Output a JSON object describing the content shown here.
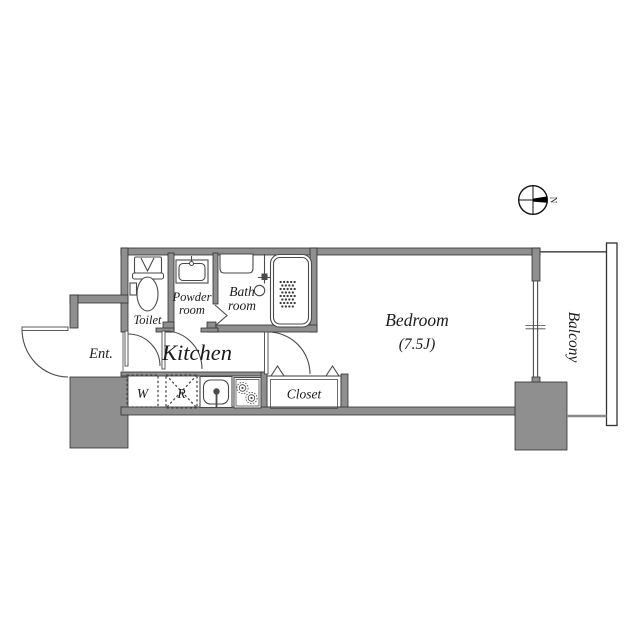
{
  "title": "Apartment floor plan",
  "compass": {
    "north_label": "N"
  },
  "rooms": {
    "entrance": {
      "label": "Ent."
    },
    "toilet": {
      "label": "Toilet"
    },
    "powder_room": {
      "line1": "Powder",
      "line2": "room"
    },
    "bath_room": {
      "line1": "Bath",
      "line2": "room"
    },
    "kitchen": {
      "label": "Kitchen"
    },
    "bedroom": {
      "label": "Bedroom",
      "size": "(7.5J)"
    },
    "closet": {
      "label": "Closet"
    },
    "balcony": {
      "label": "Balcony"
    }
  },
  "appliances": {
    "washing_machine": {
      "label": "W"
    },
    "refrigerator": {
      "label": "R"
    }
  },
  "colors": {
    "background": "#ffffff",
    "wall-fill": "#8f8f8f",
    "wall-edge": "#2e2e2e",
    "line": "#4a4a4a",
    "text": "#1c1c1c",
    "needle": "#000000"
  }
}
